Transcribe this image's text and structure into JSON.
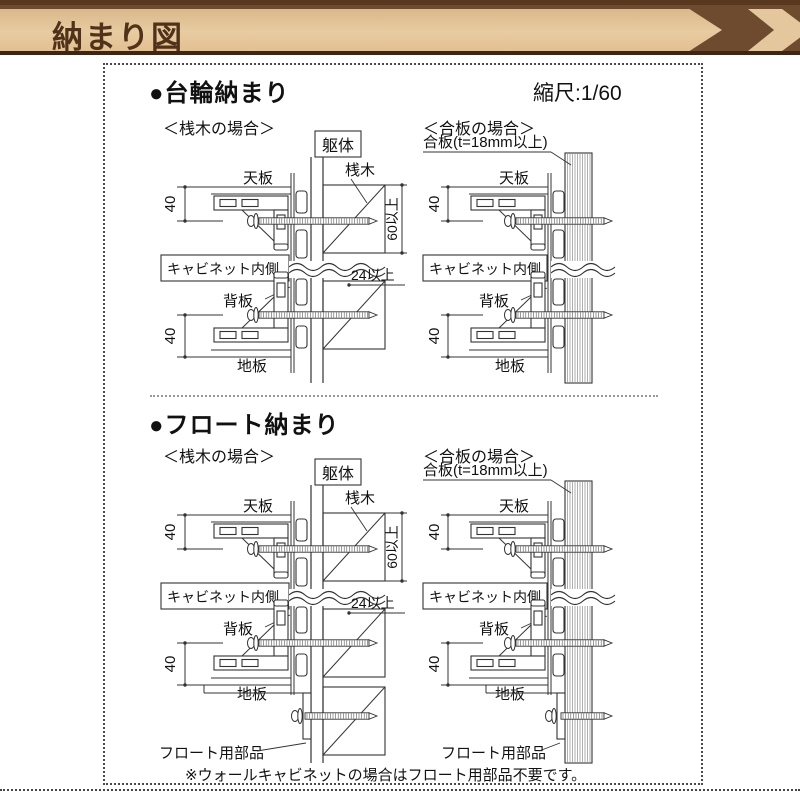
{
  "banner": {
    "title": "納まり図",
    "colors": {
      "background": "#6e4b2f",
      "ribbon": "#e5c79e",
      "text": "#4f3219"
    }
  },
  "sections": [
    {
      "heading": "●台輪納まり",
      "scale": "縮尺:1/60",
      "cases": [
        {
          "label": "＜桟木の場合＞"
        },
        {
          "label": "＜合板の場合＞"
        }
      ]
    },
    {
      "heading": "●フロート納まり",
      "cases": [
        {
          "label": "＜桟木の場合＞"
        },
        {
          "label": "＜合板の場合＞"
        }
      ]
    }
  ],
  "diagram_labels": {
    "kutai": "躯体",
    "sangi": "桟木",
    "gohan": "合板(t=18mm以上)",
    "tenban": "天板",
    "jiita": "地板",
    "haiita": "背板",
    "cabinet_inside": "キャビネット内側",
    "dim40": "40",
    "dim60": "60以上",
    "dim24": "24以上",
    "float_part": "フロート用部品"
  },
  "footnote": "※ウォールキャビネットの場合はフロート用部品不要です。",
  "drawing_line_color": "#333333"
}
